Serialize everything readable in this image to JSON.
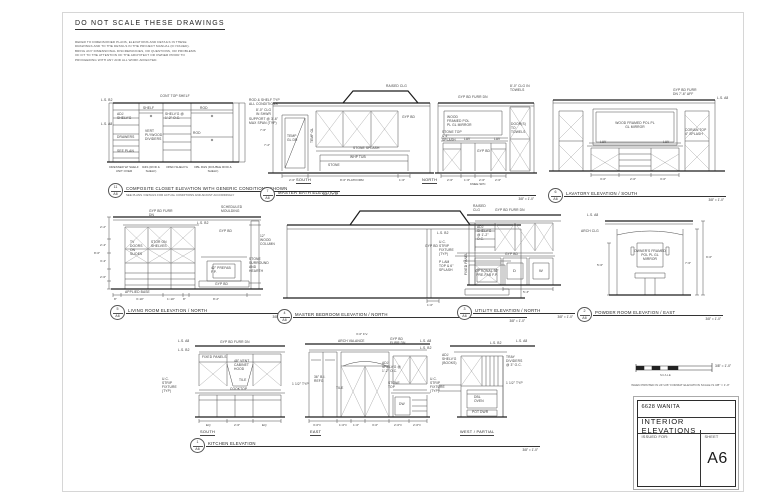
{
  "header": {
    "warning": "DO NOT SCALE THESE DRAWINGS",
    "note_lines": [
      "REFER TO DIMENSIONED PLANS, ELEVATIONS AND DETAILS IN THESE",
      "DRAWINGS AND TO THE DETAILS IN THE PROJECT MANUAL (IF ISSUED).",
      "BRING ANY DIMENSIONAL DISCREPANCIES, OR QUESTIONS, OR PROBLEMS",
      "OF FIT TO THE ATTENTION OF THE ARCHITECT OR OWNER PRIOR TO",
      "PROCEEDING WITH ANY AND ALL WORK AFFECTED."
    ]
  },
  "scale_bar": {
    "label": "3/8\" = 1'-0\"",
    "caption": "SCALE",
    "print_note": "WHEN PRINTED IN 24\"x36\" FORMAT ELEVATION SCALE IS 3/8\" = 1'-0\""
  },
  "title_block": {
    "project": "6628 WANITA",
    "sheet_title": "INTERIOR ELEVATIONS",
    "issued_for_label": "ISSUED FOR:",
    "sheet_label": "SHEET",
    "sheet_number": "A6"
  },
  "drawings": [
    {
      "number": "11",
      "sheet_ref": "A6",
      "title": "COMPOSITE CLOSET ELEVATION WITH GENERIC CONDITIONS SHOWN",
      "subtitle": "SEE PLANS / DETAILS FOR ACTUAL CONDITIONS AND ADJUST ACCORDINGLY",
      "scale": "3/8\" = 1'-0\"",
      "ann": {
        "cont_top_shelf": "CONT TOP SHELF",
        "ls_b2": "L.S. B2",
        "ls_a8": "L.S. A8",
        "adj_shelvg": "ADJ SHELV'G",
        "shelf": "SHELF",
        "shelvg_oc": "SHELV'G @ 1'-2\" O.C.",
        "rod": "ROD",
        "typ_all": "ROD & SHELF TYP ALL CONDITIONS",
        "support": "SUPPORT @ 3'-6\" MAX SPAN (TYP)",
        "vert_ply": "VERT PLYWOOD DIVIDERS",
        "drawers": "DRAWERS",
        "see_plan": "SEE PLAN"
      },
      "col_labels": [
        "DRESSER W/ SHELF UNIT OVER",
        "R&S (ROD & SHELF)",
        "OPEN SHELV'G",
        "DBL R&S (DOUBLE ROD & SHELF)"
      ]
    },
    {
      "number": "7",
      "sheet_ref": "A6",
      "title": "MASTER BATH ELEVATION",
      "scale": "3/8\" = 1'-0\"",
      "sub_labels": [
        "SOUTH",
        "NORTH"
      ],
      "ann": {
        "clg_shwr": "8'-0\" CLG IN SHWR",
        "raised_clg": "RAISED CLG",
        "gyp_bd": "GYP BD",
        "temp_gl_dr": "TEMP GL DR",
        "temp_gl": "TEMP GL",
        "stone_splash": "STONE SPLASH",
        "whp_tub": "WHP TUB",
        "stone": "STONE",
        "furr_dn": "GYP BD FURR DN",
        "mirror": "WOOD FRAMED POL PL GL MIRROR",
        "stone_top": "STONE TOP & 4\" SPLASH",
        "lav": "LAV",
        "gyp_bd2": "GYP BD",
        "doors_towels": "DOOR(S) TO TOWELS",
        "clg_towels": "8'-0\" CLG IN TOWELS",
        "knee": "KNEE SPC"
      },
      "dims": {
        "south": [
          "2'-6\"",
          "8'-0\" PLATFORM",
          "1'-6\""
        ],
        "south_left": [
          "7'-6\"",
          "7'-2\""
        ],
        "north": [
          "2'-6\"",
          "1'-6\"",
          "2'-6\"",
          "2'-6\""
        ]
      }
    },
    {
      "number": "6",
      "sheet_ref": "A6",
      "title": "LAVATORY ELEVATION / SOUTH",
      "scale": "3/8\" = 1'-0\"",
      "ann": {
        "furr": "GYP BD FURR DN 7'-6\" AFF",
        "ls_a8": "L.S. A8",
        "mirror": "WOOD FRAMED POL PL GL MIRROR",
        "lav": "LAV",
        "corian": "CORIAN TOP 4\" SPLASH"
      },
      "dims": {
        "bottom": [
          "3'-0\"",
          "2'-0\"",
          "3'-0\""
        ]
      }
    },
    {
      "number": "5",
      "sheet_ref": "A6",
      "title": "LIVING ROOM ELEVATION / NORTH",
      "scale": "3/8\" = 1'-0\"",
      "ann": {
        "furr": "GYP BD FURR DN",
        "ls_b2": "L.S. B2",
        "sched": "SCHEDULED MOULDING",
        "gyp": "GYP BD",
        "column": "12\" WOOD COLUMN",
        "tv": "TV DOORS ON SLIDES",
        "stor": "STOR ON SHELVES",
        "fp": "42\" PREFAB F.P.",
        "stone": "STONE SURROUND AND HEARTH",
        "gyp2": "GYP BD",
        "base": "APPLIED BASE"
      },
      "dims": {
        "bottom": [
          "8\"",
          "3'-10\"",
          "1'-10\"",
          "8\"",
          "8'-2\""
        ],
        "left": [
          "2'-2\"",
          "2'-4\"",
          "3'-4\"",
          "2'-6\"",
          "8'-0\""
        ]
      }
    },
    {
      "number": "4",
      "sheet_ref": "A6",
      "title": "MASTER BEDROOM ELEVATION / NORTH",
      "scale": "3/8\" = 1'-0\"",
      "ann": {
        "raised": "RAISED CLG",
        "ls_b2": "L.S. B2",
        "gyp": "GYP BD",
        "fp": "OPTIONAL 36\" PRE-FAB F.P."
      },
      "dims": {
        "bottom": [
          "1'-0\""
        ]
      }
    },
    {
      "number": "3",
      "sheet_ref": "A6",
      "title": "UTILITY ELEVATION / NORTH",
      "scale": "3/8\" = 1'-0\"",
      "ann": {
        "furr": "GYP BD FURR DN",
        "shelvg": "ADJ SHELV'G @ 1'-2\" O.C.",
        "panel": "FIXED PANEL",
        "uc": "U.C. STRIP FIXTURE (TYP)",
        "plam": "P LAM TOP & 6\" SPLASH",
        "gyp": "GYP BD",
        "dryer": "D",
        "washer": "W"
      },
      "dims": {
        "bottom": [
          "5'-3\""
        ]
      }
    },
    {
      "number": "2",
      "sheet_ref": "A6",
      "title": "POWDER ROOM ELEVATION / EAST",
      "scale": "3/8\" = 1'-0\"",
      "ann": {
        "ls_a8": "L.S. A8",
        "arch": "ARCH CLG",
        "mirror": "OWNER'S FRAMED POL PL GL MIRROR"
      },
      "dims": {
        "right": [
          "9'-0\"",
          "7'-6\""
        ],
        "left": [
          "5'-6\""
        ]
      }
    },
    {
      "number": "1",
      "sheet_ref": "A6",
      "title": "KITCHEN ELEVATION",
      "scale": "3/8\" = 1'-0\"",
      "sub_labels": [
        "SOUTH",
        "EAST",
        "WEST / PARTIAL"
      ],
      "ann": {
        "ls_a8": "L.S. A8",
        "ls_b2": "L.S. B2",
        "furr": "GYP BD FURR DN",
        "fixed": "FIXED PANELS",
        "hood": "48\" VENT CABINET HOOD",
        "tile": "TILE",
        "uc": "U.C. STRIP FIXTURE (TYP)",
        "cooktop": "COOKTOP",
        "fv": "3'-0\" F.V.",
        "valance": "ARCH VALANCE",
        "adj": "ADJ SHELV'G @ 1'-2\" O.C.",
        "refg": "36\" B.I. REFG",
        "typ": "1 1/2\" TYP",
        "stone": "STONE TOP",
        "dw": "DW",
        "books": "ADJ SHELV'G (BOOKS)",
        "tray": "TRAY DIVIDERS @ 3\" O.C.",
        "oven": "DBL OVEN",
        "pot": "POT DWR"
      },
      "dims": {
        "south": [
          "EQ",
          "2'-6\"",
          "EQ"
        ],
        "east": [
          "3'-0\"±",
          "1'-0\"±",
          "1'-0\"",
          "3'-0\"",
          "2'-0\"±",
          "2'-0\"±"
        ]
      }
    }
  ]
}
